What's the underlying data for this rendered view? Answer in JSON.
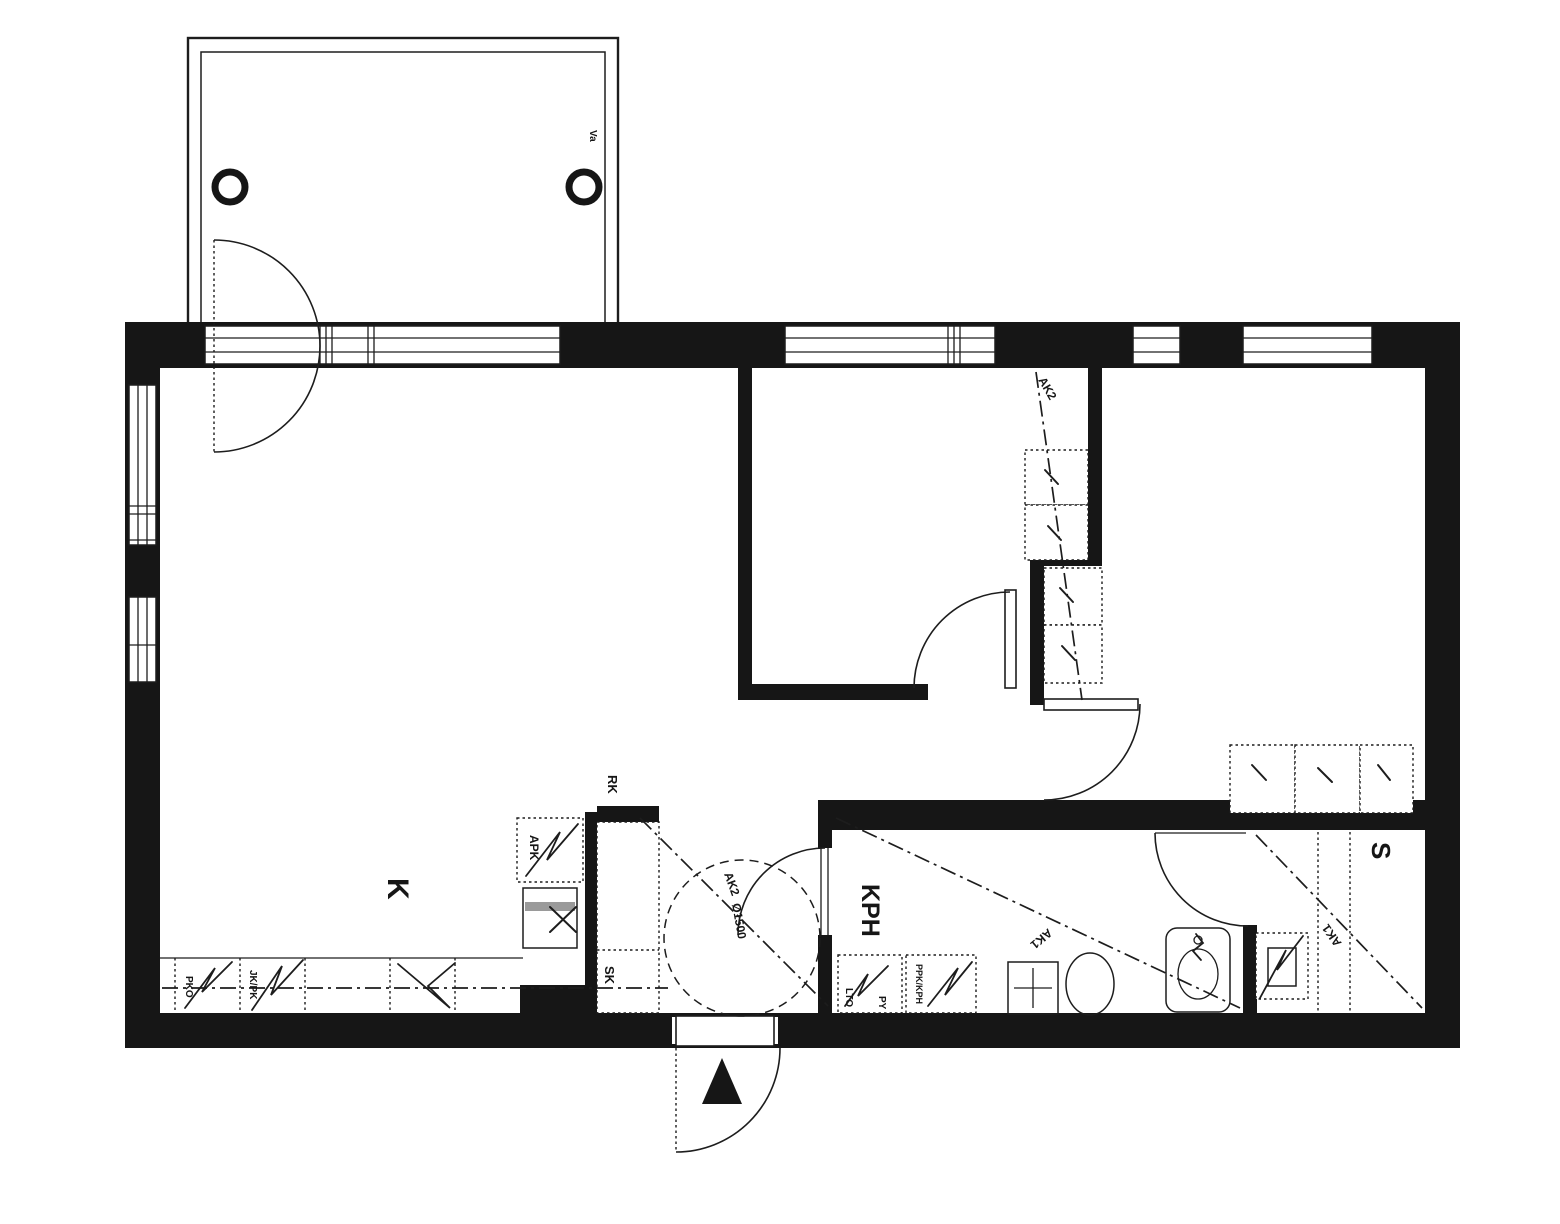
{
  "document": {
    "type": "apartment-floor-plan"
  },
  "colors": {
    "wall": "#161616",
    "background": "#ffffff",
    "line": "#1d1d1d",
    "shade": "#9a9a9a"
  },
  "rooms": {
    "kitchen_label": "K",
    "bathroom_label": "KPH",
    "sauna_label": "S"
  },
  "fixtures": {
    "rk_label": "RK",
    "apk_label": "APK",
    "sk_label": "SK",
    "jk_pk_label": "JK/PK",
    "pko_label": "PKO",
    "lto_label": "LTO",
    "py_label": "PY",
    "ppk_kph_label": "PPK/KPH"
  },
  "ceiling": {
    "ak1_label": "AK1",
    "ak2_label": "AK2"
  },
  "annotations": {
    "turning_circle_label": "Ø1500",
    "balcony_note_label": "Va"
  }
}
